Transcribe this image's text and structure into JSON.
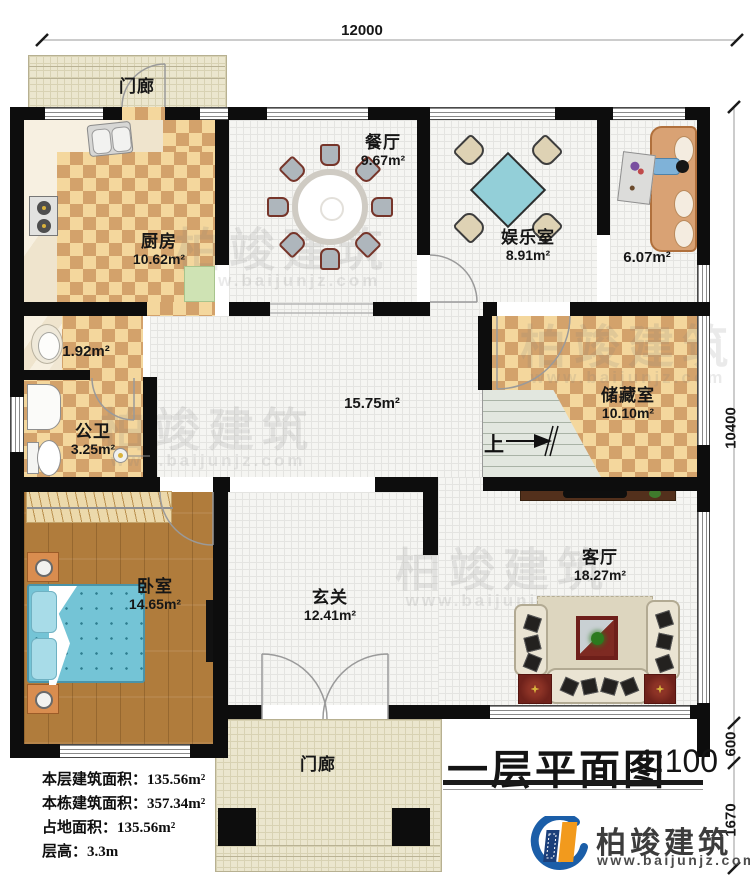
{
  "plan": {
    "title": "一层平面图",
    "scale": "1:100"
  },
  "dimensions": {
    "top_width": "12000",
    "right_height": "10400",
    "right_offset": "600",
    "right_porch": "1670"
  },
  "rooms": {
    "porch_top": {
      "name": "门廊"
    },
    "kitchen": {
      "name": "厨房",
      "area": "10.62m²"
    },
    "dining": {
      "name": "餐厅",
      "area": "9.67m²"
    },
    "entertainment": {
      "name": "娱乐室",
      "area": "8.91m²"
    },
    "lounge": {
      "area": "6.07m²"
    },
    "store_small": {
      "area": "1.92m²"
    },
    "bathroom": {
      "name": "公卫",
      "area": "3.25m²"
    },
    "hall": {
      "area": "15.75m²"
    },
    "storage": {
      "name": "储藏室",
      "area": "10.10m²"
    },
    "bedroom": {
      "name": "卧室",
      "area": "14.65m²"
    },
    "foyer": {
      "name": "玄关",
      "area": "12.41m²"
    },
    "living": {
      "name": "客厅",
      "area": "18.27m²"
    },
    "porch_bottom": {
      "name": "门廊"
    }
  },
  "stairs": {
    "up_label": "上"
  },
  "info_block": {
    "rows": [
      {
        "label": "本层建筑面积：",
        "value": "135.56m²"
      },
      {
        "label": "本栋建筑面积：",
        "value": "357.34m²"
      },
      {
        "label": "占地面积：",
        "value": "135.56m²"
      },
      {
        "label": "层高：",
        "value": "3.3m"
      }
    ]
  },
  "branding": {
    "company": "柏竣建筑",
    "website": "www.baijunjz.com"
  },
  "watermark": {
    "text": "柏竣建筑",
    "sub": "www.baijunjz.com"
  },
  "colors": {
    "wall": "#0d0d0d",
    "checker_light": "#f4d79d",
    "checker_dark": "#d3a26b",
    "porch_floor": "#ebe6ce",
    "wood_floor": "#b07c3c",
    "bed_blue": "#74c4d6",
    "stair_green": "#e2e7df",
    "sofa_brown": "#d9a274",
    "rug_red": "#6f221b",
    "logo_blue": "#1b5ea8",
    "logo_orange": "#f29a1d"
  }
}
